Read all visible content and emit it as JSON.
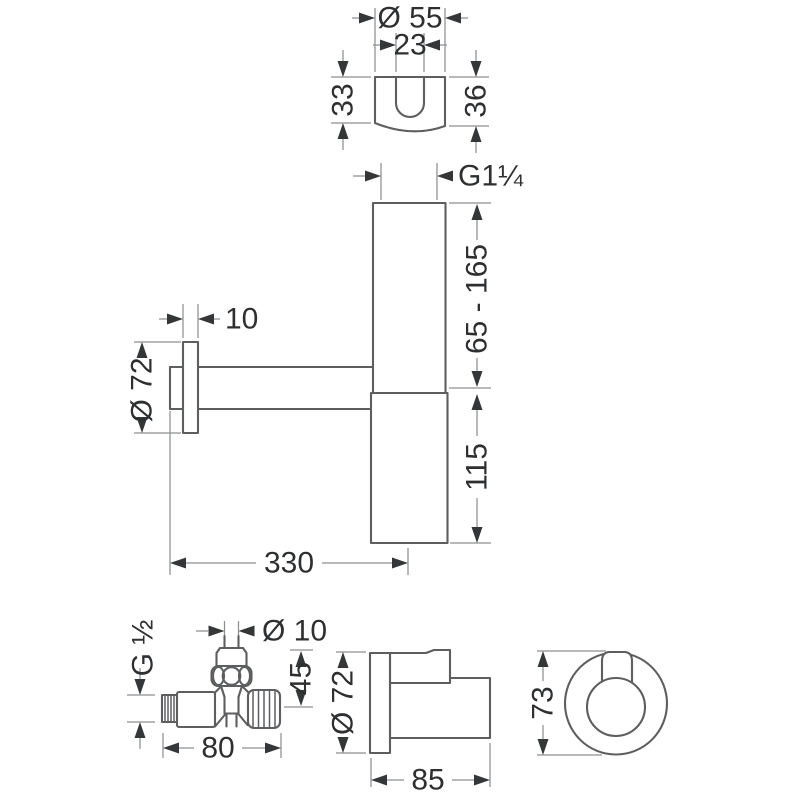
{
  "page": {
    "background": "#ffffff",
    "line_color": "#5d5e60",
    "dim_line_color": "#8e8f91",
    "text_color": "#2e2f31"
  },
  "dims": {
    "bracket": {
      "outer_diameter": "Ø 55",
      "slot_width": "23",
      "left_height": "33",
      "right_height": "36"
    },
    "siphon": {
      "inlet_thread": "G1¼",
      "adjustable_height": "65 - 165",
      "lower_body_height": "115",
      "flange_thickness": "10",
      "flange_diameter": "Ø 72",
      "wall_to_trap_center": "330"
    },
    "valve": {
      "inlet_thread": "G ½",
      "spindle_diameter": "Ø 10",
      "height_above_axis": "45",
      "overall_length": "80"
    },
    "outlet_side": {
      "flange_diameter": "Ø 72",
      "overall_depth": "85"
    },
    "outlet_front": {
      "overall_height": "73"
    }
  }
}
